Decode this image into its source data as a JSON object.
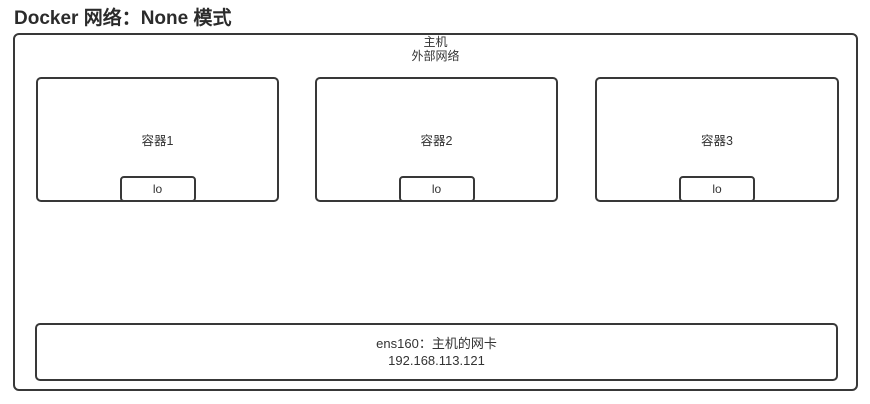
{
  "title": "Docker 网络：None 模式",
  "host": {
    "label_line1": "主机",
    "label_line2": "外部网络"
  },
  "containers": [
    {
      "label": "容器1",
      "interface": "lo"
    },
    {
      "label": "容器2",
      "interface": "lo"
    },
    {
      "label": "容器3",
      "interface": "lo"
    }
  ],
  "nic": {
    "line1": "ens160：主机的网卡",
    "line2": "192.168.113.121"
  },
  "colors": {
    "border": "#383838",
    "text": "#333333",
    "title": "#2b2b2b",
    "background": "#ffffff"
  }
}
